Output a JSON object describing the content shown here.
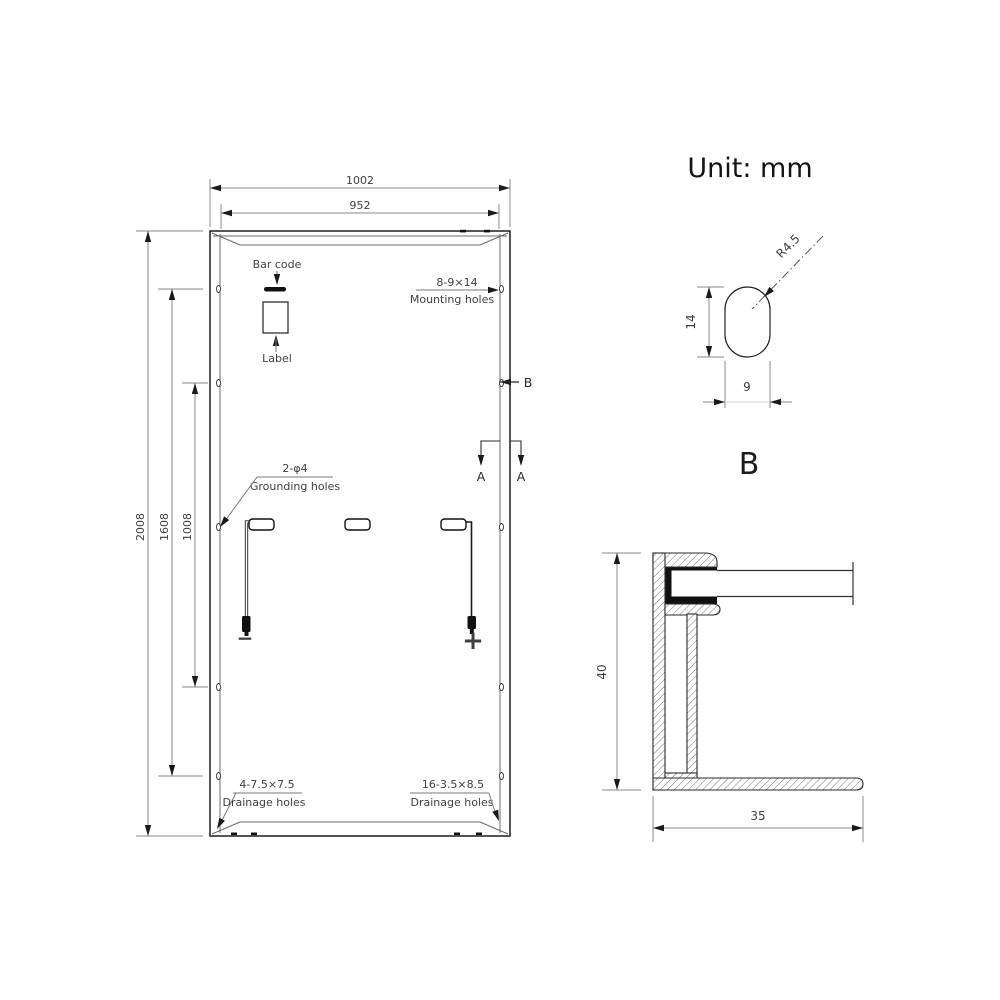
{
  "unit_label": "Unit: mm",
  "panel_view": {
    "dims": {
      "outer_width": "1002",
      "inner_width": "952",
      "outer_height": "2008",
      "mount_span_outer": "1608",
      "mount_span_inner": "1008"
    },
    "barcode": {
      "label": "Bar code"
    },
    "nameplate": {
      "label": "Label"
    },
    "mounting_holes": {
      "spec": "8-9×14",
      "label": "Mounting holes"
    },
    "grounding_holes": {
      "spec": "2-φ4",
      "label": "Grounding holes"
    },
    "drainage_holes_left": {
      "spec": "4-7.5×7.5",
      "label": "Drainage holes"
    },
    "drainage_holes_right": {
      "spec": "16-3.5×8.5",
      "label": "Drainage holes"
    },
    "section_markers": {
      "b": "B",
      "a_left": "A",
      "a_right": "A"
    },
    "connectors": {
      "negative": "−",
      "positive": "+"
    }
  },
  "detail_b": {
    "title": "B",
    "corner_radius": "R4.5",
    "slot_height": "14",
    "slot_width": "9"
  },
  "frame_section": {
    "height": "40",
    "width": "35"
  },
  "colors": {
    "object_line": "#2b2b2b",
    "dimension_line": "#8a8a8a",
    "text": "#3f3f3f",
    "solid_fill": "#111111",
    "background": "#ffffff"
  }
}
